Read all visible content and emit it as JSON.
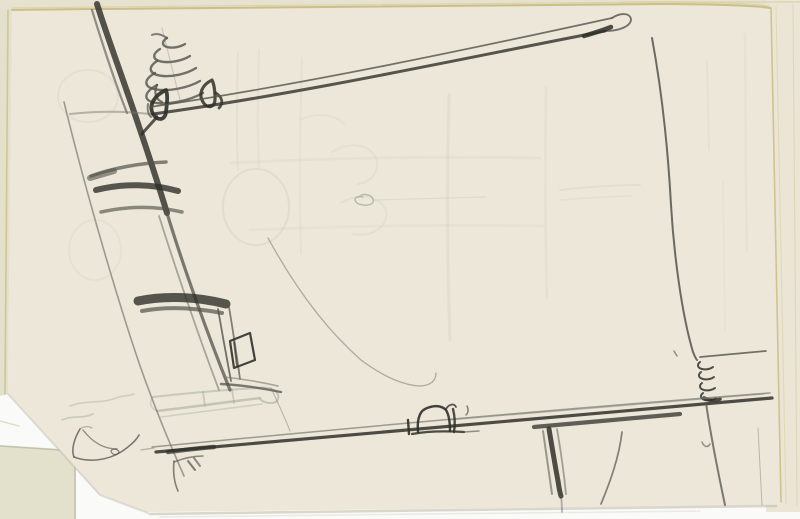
{
  "meta": {
    "title": "Sketchbook page — loose graphite pencil sketch",
    "media": "graphite pencil on cream sketchbook paper, scanned",
    "canvas": {
      "width": 800,
      "height": 519
    }
  },
  "colors": {
    "scan_bg": "#fafaf8",
    "paper": "#ece7d8",
    "paper_top_band": "#e7e2cf",
    "paper_under": "#e3e0cc",
    "paper_right_stack": "#eae5d5",
    "edge_tan": "#c8ba7e",
    "edge_tan_light": "#d9cfa2",
    "edge_shadow": "#bdb9a8",
    "pencil_dark": "#30302b",
    "pencil_mid": "#53534c",
    "pencil_light": "#79796f",
    "ghost_green": "#9ba394",
    "ghost_faint": "#aab0a0"
  },
  "scene": {
    "description": "Loose pencil sketch on a cream sketchbook page: a long slanted lance-like bar with a coiled spring and two dark ring marks at its left end, a slanted ladder-like structure with dark rungs on the left, a long near-horizontal bottom rail carrying a small box-shaped rider, a small coil joining a vertical frame line to the rail at the right, faint bleed-through ghost shapes, a small shoe-like curve at lower left, and the clipped lower-left corner of the page revealing the sheet beneath.",
    "elements": [
      {
        "name": "sketch-page",
        "label": "cream sketchbook page with clipped lower-left corner"
      },
      {
        "name": "underlying-pages",
        "label": "edges of underlying sheets visible at top, left, right and lower-left"
      },
      {
        "name": "spring-coil-large",
        "label": "tapered coil spring drawn above the left end of the lance bar"
      },
      {
        "name": "dark-rings",
        "label": "two heavy dark ring marks where the bar crosses the left structure"
      },
      {
        "name": "lance-bar",
        "label": "long slanted double-line bar rising to a looped tip at upper right"
      },
      {
        "name": "ladder-structure",
        "label": "slanted ladder-like frame with dark rungs on the left side"
      },
      {
        "name": "hanging-box",
        "label": "small open box outline on the ladder's lower strip"
      },
      {
        "name": "right-frame-line",
        "label": "long vertical frame line descending the right side"
      },
      {
        "name": "small-spring-right",
        "label": "small coil joining the vertical line to the bottom rail"
      },
      {
        "name": "bottom-rail",
        "label": "long near-horizontal double rail across the lower page"
      },
      {
        "name": "rider-box",
        "label": "small dark box shape riding on the bottom rail"
      },
      {
        "name": "dark-post",
        "label": "heavy short vertical stroke below the rail"
      },
      {
        "name": "trailing-curves",
        "label": "light curved strokes trailing below the rail"
      },
      {
        "name": "shoe-curve",
        "label": "small shoe-like curved mark at lower left"
      },
      {
        "name": "flag-mark",
        "label": "tiny flag-like pencil mark near the bottom edge"
      },
      {
        "name": "ghost-impressions",
        "label": "faint bleed-through circles, grid lines, cylinder shape and scribbles"
      }
    ]
  }
}
